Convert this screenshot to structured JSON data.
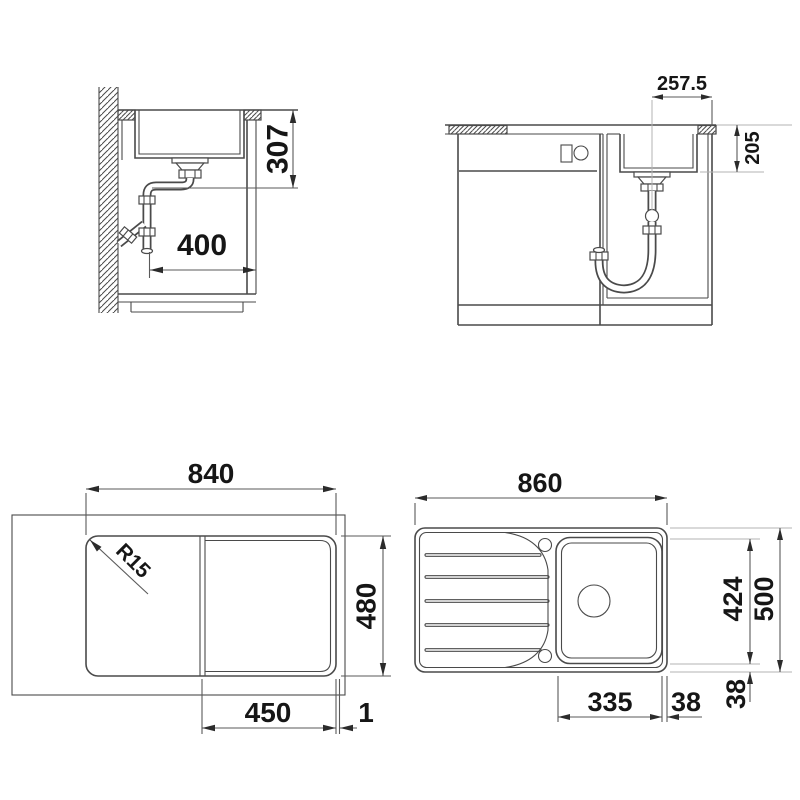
{
  "drawing": {
    "side_view": {
      "bowl_depth": "307",
      "drain_offset": "400"
    },
    "front_view": {
      "drain_from_edge": "257.5",
      "bowl_depth": "205"
    },
    "cutout_view": {
      "width": "840",
      "depth": "480",
      "right_section": "450",
      "edge_gap": "1",
      "corner_radius": "R15"
    },
    "top_view": {
      "width": "860",
      "bowl_length": "424",
      "depth": "500",
      "bowl_width": "335",
      "bowl_to_edge": "38",
      "bowl_to_front": "38"
    }
  }
}
